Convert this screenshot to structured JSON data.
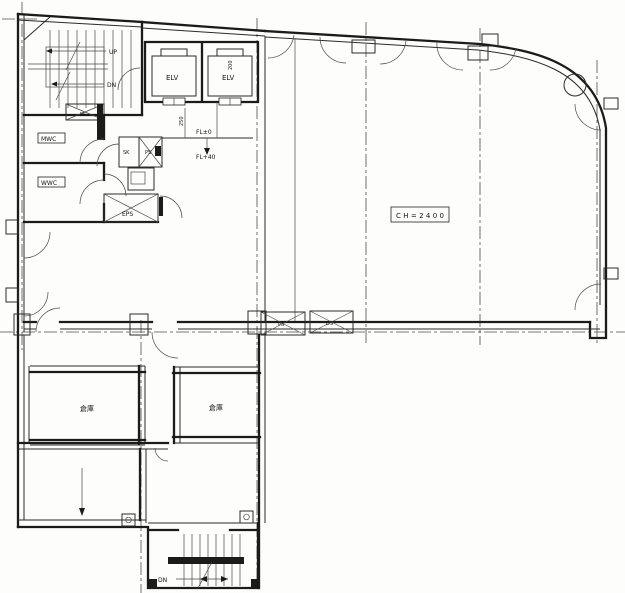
{
  "colors": {
    "ink": "#1b1b1b",
    "paper": "#fdfdfb"
  },
  "stairwell_top": {
    "up": "UP",
    "down": "DN"
  },
  "elevators": {
    "car1": "ELV",
    "car2": "ELV",
    "dim": "200"
  },
  "shafts": {
    "ps_top": "PS",
    "ps_small": "PS",
    "sk": "SK",
    "eps": "EPS",
    "ps_mid": "PS",
    "ds_mid": "DS"
  },
  "restrooms": {
    "mwc": "MWC",
    "wwc": "WWC"
  },
  "levels": {
    "fl_zero": "FL±0",
    "fl_plus40": "FL+40",
    "dim": "250"
  },
  "main_room": {
    "ceiling_height": "CH=2400"
  },
  "storage_rooms": {
    "room1": "倉庫",
    "room2": "倉庫"
  },
  "stairwell_bottom": {
    "down": "DN"
  }
}
